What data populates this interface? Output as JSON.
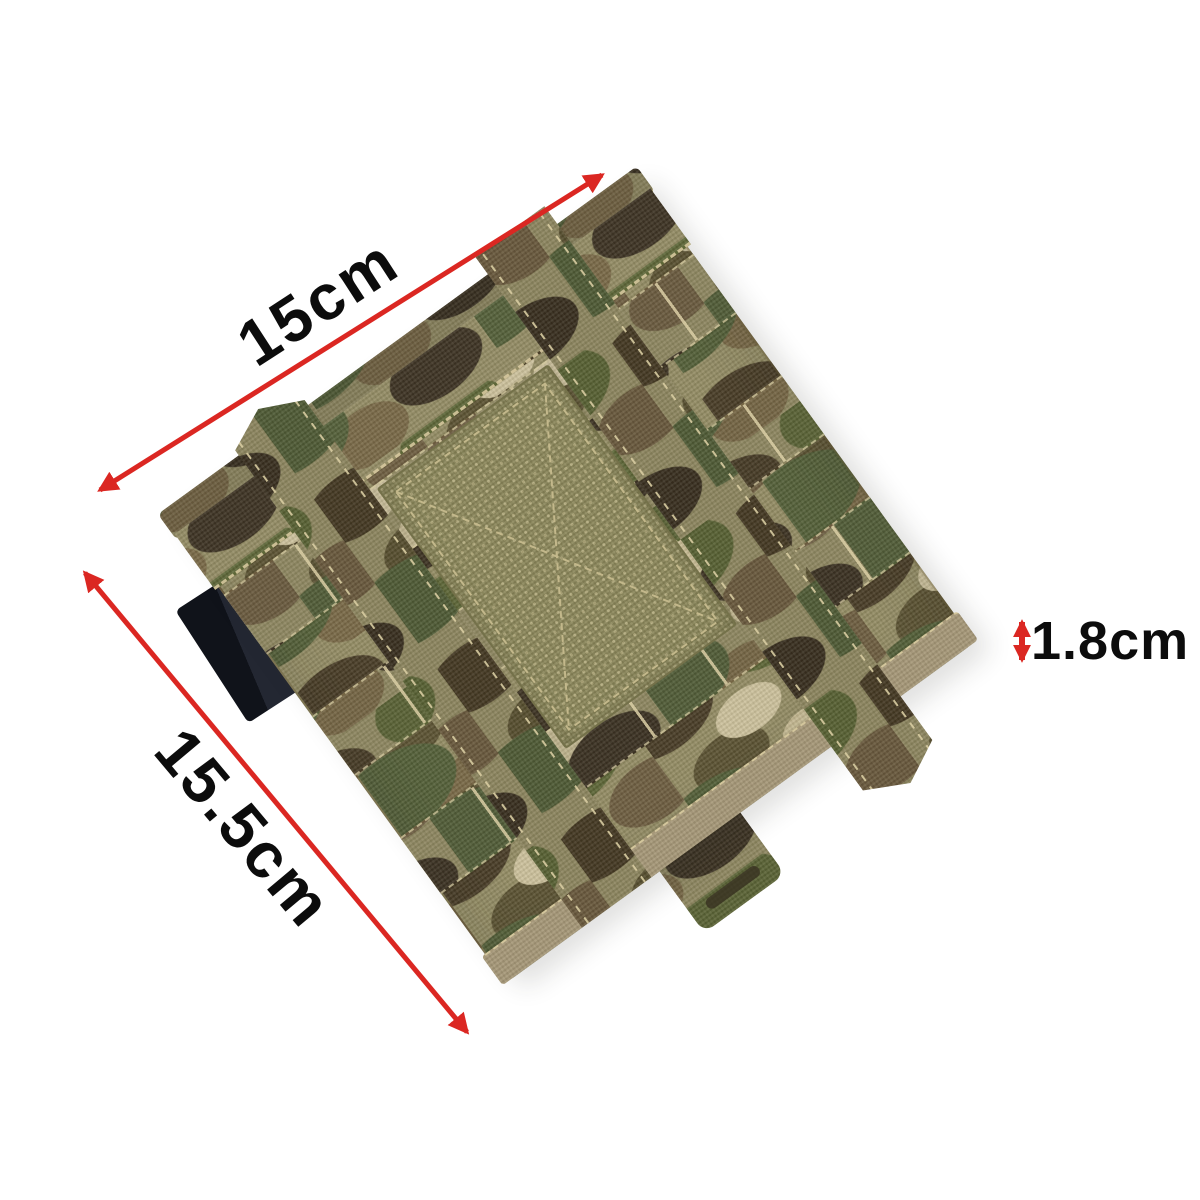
{
  "scene": {
    "description": "Multicam camouflage MOLLE admin / side-plate pouch photographed flat on a white background with red dimension arrows",
    "background": "#ffffff"
  },
  "pouch": {
    "pattern": "multicam camouflage",
    "camo_palette": [
      "#948d65",
      "#4a3e28",
      "#5e6738",
      "#6f5f42",
      "#cdc29d",
      "#55613a",
      "#3e3424",
      "#7a6a48"
    ],
    "velcro_panel_color": "#8a8659",
    "black_strap_color": "#14171c",
    "binding_color": "#a69878"
  },
  "annotations": {
    "arrow_color": "#db2722",
    "label_color": "#0c0c0c",
    "width": {
      "label": "15cm"
    },
    "height": {
      "label": "15.5cm"
    },
    "thickness": {
      "label": "1.8cm"
    }
  }
}
